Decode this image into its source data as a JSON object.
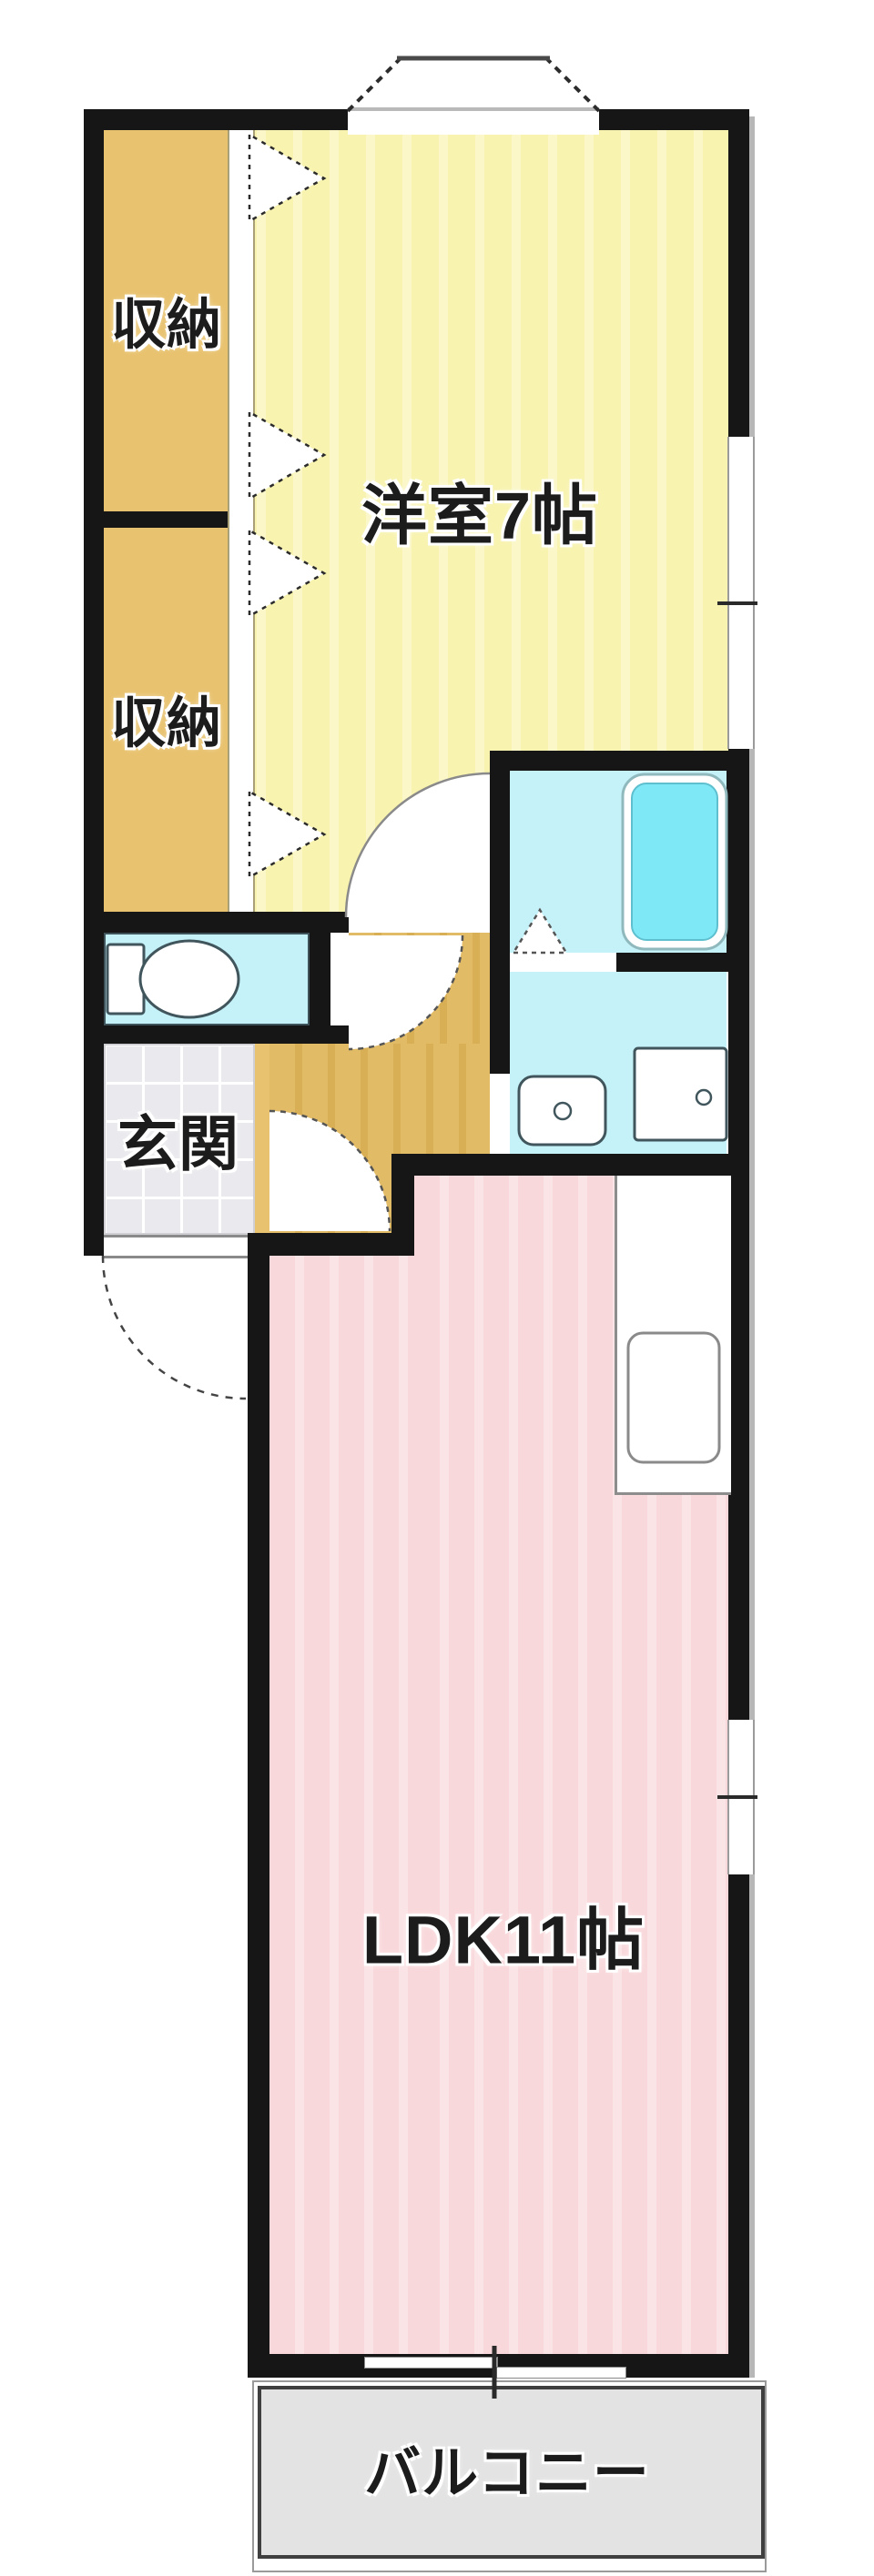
{
  "floorplan": {
    "rooms": {
      "bedroom": {
        "label": "洋室7帖"
      },
      "closet_upper": {
        "label": "収納"
      },
      "closet_lower": {
        "label": "収納"
      },
      "entrance": {
        "label": "玄関"
      },
      "ldk": {
        "label": "LDK11帖"
      },
      "balcony": {
        "label": "バルコニー"
      }
    },
    "colors": {
      "wall": "#161616",
      "bedroom_floor": "#F8F3AE",
      "closet_floor": "#E8C26E",
      "hallway_floor": "#E2BB66",
      "wet_area": "#C5F1F8",
      "bathtub_water": "#7FE8F7",
      "ldk_floor": "#F9D8DB",
      "entrance_tile": "#EAEAEE",
      "balcony_floor": "#E3E3E3"
    }
  }
}
